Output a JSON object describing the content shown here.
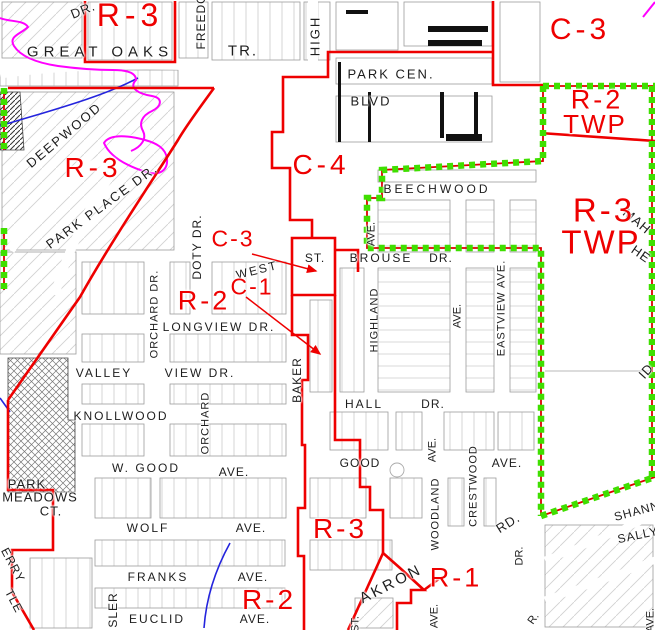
{
  "canvas": {
    "width": 655,
    "height": 630
  },
  "colors": {
    "zone_boundary_red": "#ee0000",
    "city_limit_green": "#3fdf00",
    "subdivision_magenta": "#ff00ff",
    "stream_blue": "#2424dd",
    "street_text": "#1d1d1d",
    "parcel_line_gray": "#c8c8c8"
  },
  "zone_labels": [
    {
      "id": "r3-great-oaks",
      "text": "R-3",
      "x": 130,
      "y": 15,
      "size": 32,
      "spacing": 5,
      "rot": 0
    },
    {
      "id": "c3-northeast",
      "text": "C-3",
      "x": 580,
      "y": 30,
      "size": 30,
      "spacing": 4,
      "rot": 0
    },
    {
      "id": "r2-twp",
      "text": "R-2",
      "x": 597,
      "y": 100,
      "size": 27,
      "spacing": 3,
      "rot": 0
    },
    {
      "id": "r2-twp-line2",
      "text": "TWP",
      "x": 595,
      "y": 124,
      "size": 26,
      "spacing": 2,
      "rot": 0
    },
    {
      "id": "r3-deepwood",
      "text": "R-3",
      "x": 93,
      "y": 168,
      "size": 28,
      "spacing": 4,
      "rot": 0
    },
    {
      "id": "c4-center",
      "text": "C-4",
      "x": 321,
      "y": 165,
      "size": 28,
      "spacing": 4,
      "rot": 0
    },
    {
      "id": "c3-west-st",
      "text": "C-3",
      "x": 233,
      "y": 239,
      "size": 23,
      "spacing": 2,
      "rot": 0
    },
    {
      "id": "c1-baker",
      "text": "C-1",
      "x": 252,
      "y": 287,
      "size": 23,
      "spacing": 2,
      "rot": 0
    },
    {
      "id": "r2-longview",
      "text": "R-2",
      "x": 204,
      "y": 301,
      "size": 27,
      "spacing": 3,
      "rot": 0
    },
    {
      "id": "r3-twp-east",
      "text": "R-3",
      "x": 604,
      "y": 210,
      "size": 33,
      "spacing": 3,
      "rot": 0
    },
    {
      "id": "r3-twp-east-line2",
      "text": "TWP",
      "x": 601,
      "y": 242,
      "size": 33,
      "spacing": 2,
      "rot": 0
    },
    {
      "id": "r3-baker-south",
      "text": "R-3",
      "x": 340,
      "y": 529,
      "size": 28,
      "spacing": 3,
      "rot": 0
    },
    {
      "id": "r2-south",
      "text": "R-2",
      "x": 269,
      "y": 600,
      "size": 28,
      "spacing": 3,
      "rot": 0
    },
    {
      "id": "r1-southeast",
      "text": "R-1",
      "x": 456,
      "y": 578,
      "size": 27,
      "spacing": 3,
      "rot": 0
    }
  ],
  "street_labels": [
    {
      "id": "dr-northwest",
      "text": "DR.",
      "x": 83,
      "y": 10,
      "size": 13,
      "rot": -22,
      "spacing": 1
    },
    {
      "id": "great-oaks",
      "text": "GREAT OAKS",
      "x": 100,
      "y": 52,
      "size": 15,
      "rot": 0,
      "spacing": 5
    },
    {
      "id": "tr",
      "text": "TR.",
      "x": 243,
      "y": 51,
      "size": 15,
      "rot": 0,
      "spacing": 2
    },
    {
      "id": "freedom",
      "text": "FREEDOM",
      "x": 201,
      "y": 16,
      "size": 12,
      "rot": -90,
      "spacing": 1
    },
    {
      "id": "high",
      "text": "HIGH",
      "x": 315,
      "y": 36,
      "size": 13,
      "rot": -90,
      "spacing": 2
    },
    {
      "id": "park-cen",
      "text": "PARK CEN.",
      "x": 391,
      "y": 74,
      "size": 13,
      "rot": 0,
      "spacing": 2
    },
    {
      "id": "blvd",
      "text": "BLVD",
      "x": 371,
      "y": 101,
      "size": 13,
      "rot": 0,
      "spacing": 2
    },
    {
      "id": "beechwood",
      "text": "BEECHWOOD",
      "x": 437,
      "y": 189,
      "size": 12,
      "rot": 0,
      "spacing": 3
    },
    {
      "id": "deepwood",
      "text": "DEEPWOOD",
      "x": 64,
      "y": 135,
      "size": 13,
      "rot": -40,
      "spacing": 2
    },
    {
      "id": "park-place-dr",
      "text": "PARK PLACE DR.",
      "x": 102,
      "y": 206,
      "size": 13,
      "rot": -36,
      "spacing": 2
    },
    {
      "id": "doty-dr",
      "text": "DOTY DR.",
      "x": 197,
      "y": 247,
      "size": 12,
      "rot": -90,
      "spacing": 1
    },
    {
      "id": "west",
      "text": "WEST",
      "x": 257,
      "y": 270,
      "size": 12,
      "rot": -14,
      "spacing": 2
    },
    {
      "id": "st-west",
      "text": "ST.",
      "x": 315,
      "y": 258,
      "size": 12,
      "rot": 0,
      "spacing": 1
    },
    {
      "id": "brouse",
      "text": "BROUSE",
      "x": 381,
      "y": 258,
      "size": 12,
      "rot": 0,
      "spacing": 2
    },
    {
      "id": "brouse-dr",
      "text": "DR.",
      "x": 441,
      "y": 258,
      "size": 12,
      "rot": 0,
      "spacing": 1
    },
    {
      "id": "ave-highland-north",
      "text": "AVE.",
      "x": 372,
      "y": 234,
      "size": 11,
      "rot": -90,
      "spacing": 0
    },
    {
      "id": "highland",
      "text": "HIGHLAND",
      "x": 375,
      "y": 320,
      "size": 11,
      "rot": -90,
      "spacing": 1
    },
    {
      "id": "ave-middle",
      "text": "AVE.",
      "x": 458,
      "y": 316,
      "size": 11,
      "rot": -90,
      "spacing": 0
    },
    {
      "id": "eastview-ave",
      "text": "EASTVIEW AVE.",
      "x": 502,
      "y": 308,
      "size": 11,
      "rot": -90,
      "spacing": 1
    },
    {
      "id": "mah-fragment",
      "text": "MAH",
      "x": 637,
      "y": 221,
      "size": 13,
      "rot": 40,
      "spacing": 1
    },
    {
      "id": "he-fragment",
      "text": "HE",
      "x": 641,
      "y": 254,
      "size": 13,
      "rot": 35,
      "spacing": 1
    },
    {
      "id": "id-fragment",
      "text": "ID",
      "x": 646,
      "y": 371,
      "size": 13,
      "rot": -48,
      "spacing": 1
    },
    {
      "id": "orchard-dr",
      "text": "ORCHARD DR.",
      "x": 155,
      "y": 314,
      "size": 11,
      "rot": -90,
      "spacing": 1
    },
    {
      "id": "longview-dr",
      "text": "LONGVIEW DR.",
      "x": 219,
      "y": 327,
      "size": 12,
      "rot": 0,
      "spacing": 2
    },
    {
      "id": "valley",
      "text": "VALLEY",
      "x": 104,
      "y": 373,
      "size": 12,
      "rot": 0,
      "spacing": 2
    },
    {
      "id": "view-dr",
      "text": "VIEW DR.",
      "x": 200,
      "y": 373,
      "size": 12,
      "rot": 0,
      "spacing": 2
    },
    {
      "id": "baker",
      "text": "BAKER",
      "x": 297,
      "y": 380,
      "size": 12,
      "rot": -90,
      "spacing": 1
    },
    {
      "id": "knollwood",
      "text": "KNOLLWOOD",
      "x": 121,
      "y": 416,
      "size": 12,
      "rot": 0,
      "spacing": 2
    },
    {
      "id": "orchard",
      "text": "ORCHARD",
      "x": 206,
      "y": 423,
      "size": 11,
      "rot": -90,
      "spacing": 1
    },
    {
      "id": "w-good",
      "text": "W. GOOD",
      "x": 146,
      "y": 468,
      "size": 12,
      "rot": 0,
      "spacing": 2
    },
    {
      "id": "w-good-ave",
      "text": "AVE.",
      "x": 234,
      "y": 472,
      "size": 12,
      "rot": 0,
      "spacing": 1
    },
    {
      "id": "hall",
      "text": "HALL",
      "x": 364,
      "y": 404,
      "size": 12,
      "rot": 0,
      "spacing": 2
    },
    {
      "id": "hall-dr",
      "text": "DR.",
      "x": 433,
      "y": 404,
      "size": 12,
      "rot": 0,
      "spacing": 1
    },
    {
      "id": "ave-woodland-north",
      "text": "AVE.",
      "x": 433,
      "y": 450,
      "size": 11,
      "rot": -90,
      "spacing": 0
    },
    {
      "id": "good",
      "text": "GOOD",
      "x": 360,
      "y": 463,
      "size": 12,
      "rot": 0,
      "spacing": 1
    },
    {
      "id": "good-ave-east",
      "text": "AVE.",
      "x": 507,
      "y": 463,
      "size": 12,
      "rot": 0,
      "spacing": 1
    },
    {
      "id": "wolf",
      "text": "WOLF",
      "x": 148,
      "y": 528,
      "size": 12,
      "rot": 0,
      "spacing": 2
    },
    {
      "id": "wolf-ave",
      "text": "AVE.",
      "x": 251,
      "y": 528,
      "size": 12,
      "rot": 0,
      "spacing": 1
    },
    {
      "id": "franks",
      "text": "FRANKS",
      "x": 158,
      "y": 577,
      "size": 12,
      "rot": 0,
      "spacing": 2
    },
    {
      "id": "franks-ave",
      "text": "AVE.",
      "x": 253,
      "y": 577,
      "size": 12,
      "rot": 0,
      "spacing": 1
    },
    {
      "id": "euclid",
      "text": "EUCLID",
      "x": 157,
      "y": 619,
      "size": 12,
      "rot": 0,
      "spacing": 2
    },
    {
      "id": "euclid-ave",
      "text": "AVE.",
      "x": 255,
      "y": 619,
      "size": 12,
      "rot": 0,
      "spacing": 1
    },
    {
      "id": "park",
      "text": "PARK",
      "x": 27,
      "y": 484,
      "size": 13,
      "rot": 0,
      "spacing": 1
    },
    {
      "id": "meadows",
      "text": "MEADOWS",
      "x": 40,
      "y": 497,
      "size": 13,
      "rot": 0,
      "spacing": 1
    },
    {
      "id": "ct",
      "text": "CT.",
      "x": 51,
      "y": 511,
      "size": 13,
      "rot": 0,
      "spacing": 1
    },
    {
      "id": "erry-fragment",
      "text": "ERRY",
      "x": 13,
      "y": 565,
      "size": 12,
      "rot": 62,
      "spacing": 1
    },
    {
      "id": "tle-fragment",
      "text": "TLE",
      "x": 14,
      "y": 601,
      "size": 12,
      "rot": 62,
      "spacing": 1
    },
    {
      "id": "sler-fragment",
      "text": "SLER",
      "x": 113,
      "y": 610,
      "size": 12,
      "rot": -90,
      "spacing": 1
    },
    {
      "id": "akron",
      "text": "AKRON",
      "x": 391,
      "y": 584,
      "size": 15,
      "rot": -27,
      "spacing": 3
    },
    {
      "id": "woodland",
      "text": "WOODLAND",
      "x": 436,
      "y": 514,
      "size": 11,
      "rot": -90,
      "spacing": 1
    },
    {
      "id": "ave-woodland-south",
      "text": "AVE.",
      "x": 435,
      "y": 616,
      "size": 11,
      "rot": -90,
      "spacing": 0
    },
    {
      "id": "crestwood",
      "text": "CRESTWOOD",
      "x": 474,
      "y": 486,
      "size": 11,
      "rot": -90,
      "spacing": 1
    },
    {
      "id": "rd",
      "text": "RD.",
      "x": 508,
      "y": 523,
      "size": 13,
      "rot": -32,
      "spacing": 1
    },
    {
      "id": "dr-southeast",
      "text": "DR.",
      "x": 520,
      "y": 556,
      "size": 11,
      "rot": -90,
      "spacing": 0
    },
    {
      "id": "shann-fragment",
      "text": "SHANN",
      "x": 637,
      "y": 511,
      "size": 12,
      "rot": -15,
      "spacing": 1
    },
    {
      "id": "sally-fragment",
      "text": "SALLY",
      "x": 638,
      "y": 535,
      "size": 12,
      "rot": -12,
      "spacing": 1
    },
    {
      "id": "r-fragment",
      "text": "R.",
      "x": 534,
      "y": 619,
      "size": 11,
      "rot": -55,
      "spacing": 0
    },
    {
      "id": "st-akron",
      "text": "ST.",
      "x": 356,
      "y": 624,
      "size": 11,
      "rot": -90,
      "spacing": 0
    },
    {
      "id": "ave-southeast",
      "text": "AVE.",
      "x": 651,
      "y": 620,
      "size": 11,
      "rot": -90,
      "spacing": 0
    }
  ]
}
